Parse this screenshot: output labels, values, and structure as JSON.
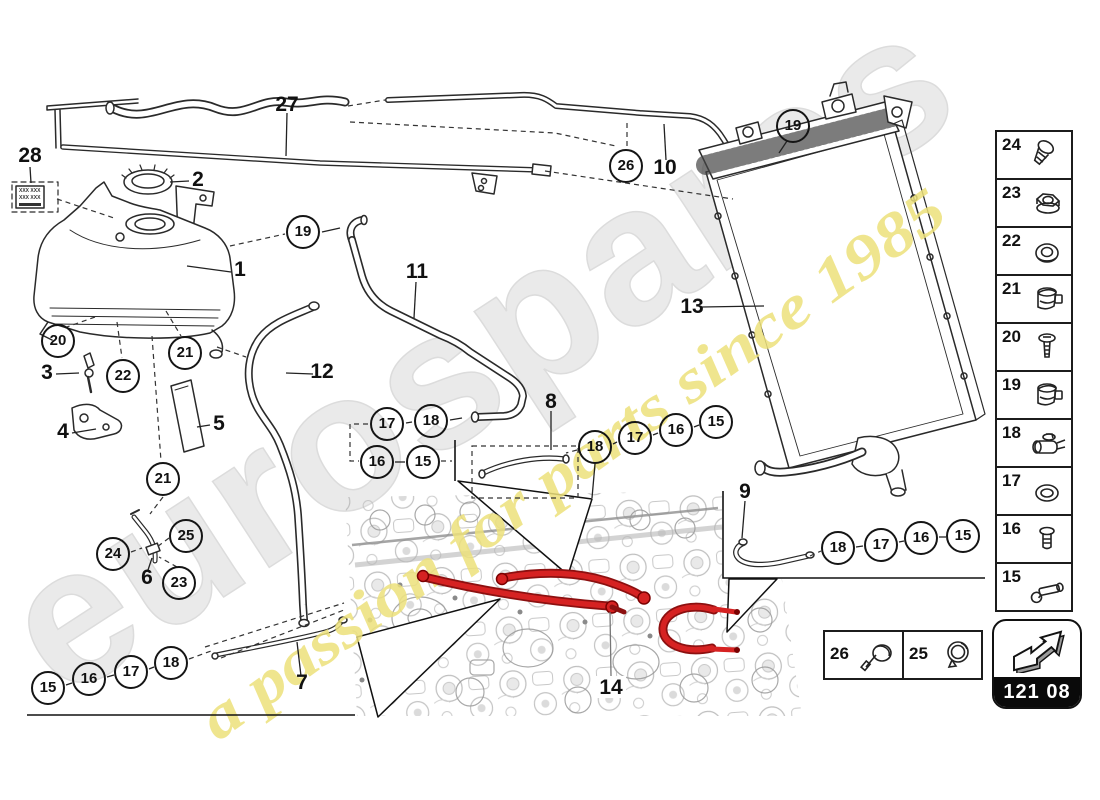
{
  "watermark": {
    "brand": "eurospares",
    "tagline": "a passion for parts since 1985",
    "brand_color": "#eaeaea",
    "tagline_color": "#ece17a"
  },
  "colors": {
    "accent_red": "#d62222",
    "line": "#2a2a2a"
  },
  "page_code": "121 08",
  "sticker": {
    "line1": "XXX XXX",
    "line2": "XXX XXX"
  },
  "sidebar": {
    "items": [
      {
        "number": "24",
        "icon": "screw-icon"
      },
      {
        "number": "23",
        "icon": "flange-nut-icon"
      },
      {
        "number": "22",
        "icon": "grommet-icon"
      },
      {
        "number": "21",
        "icon": "hose-clamp-icon"
      },
      {
        "number": "20",
        "icon": "pan-screw-icon"
      },
      {
        "number": "19",
        "icon": "hose-clamp-icon"
      },
      {
        "number": "18",
        "icon": "clip-holder-icon"
      },
      {
        "number": "17",
        "icon": "washer-icon"
      },
      {
        "number": "16",
        "icon": "bolt-icon"
      },
      {
        "number": "15",
        "icon": "sensor-bolt-icon"
      }
    ]
  },
  "legend": {
    "items": [
      {
        "number": "26",
        "icon": "clamp-screw-icon"
      },
      {
        "number": "25",
        "icon": "ring-clamp-icon"
      }
    ]
  },
  "callouts": [
    {
      "n": "19"
    },
    {
      "n": "26"
    },
    {
      "n": "19"
    },
    {
      "n": "20"
    },
    {
      "n": "22"
    },
    {
      "n": "21"
    },
    {
      "n": "21"
    },
    {
      "n": "24"
    },
    {
      "n": "25"
    },
    {
      "n": "23"
    },
    {
      "n": "17"
    },
    {
      "n": "18"
    },
    {
      "n": "16"
    },
    {
      "n": "15"
    },
    {
      "n": "18"
    },
    {
      "n": "17"
    },
    {
      "n": "16"
    },
    {
      "n": "15"
    },
    {
      "n": "18"
    },
    {
      "n": "17"
    },
    {
      "n": "16"
    },
    {
      "n": "15"
    },
    {
      "n": "15"
    },
    {
      "n": "16"
    },
    {
      "n": "17"
    },
    {
      "n": "18"
    }
  ],
  "labels": [
    {
      "t": "27"
    },
    {
      "t": "28"
    },
    {
      "t": "2"
    },
    {
      "t": "1"
    },
    {
      "t": "10"
    },
    {
      "t": "11"
    },
    {
      "t": "12"
    },
    {
      "t": "13"
    },
    {
      "t": "3"
    },
    {
      "t": "4"
    },
    {
      "t": "5"
    },
    {
      "t": "6"
    },
    {
      "t": "8"
    },
    {
      "t": "9"
    },
    {
      "t": "7"
    },
    {
      "t": "14"
    }
  ]
}
